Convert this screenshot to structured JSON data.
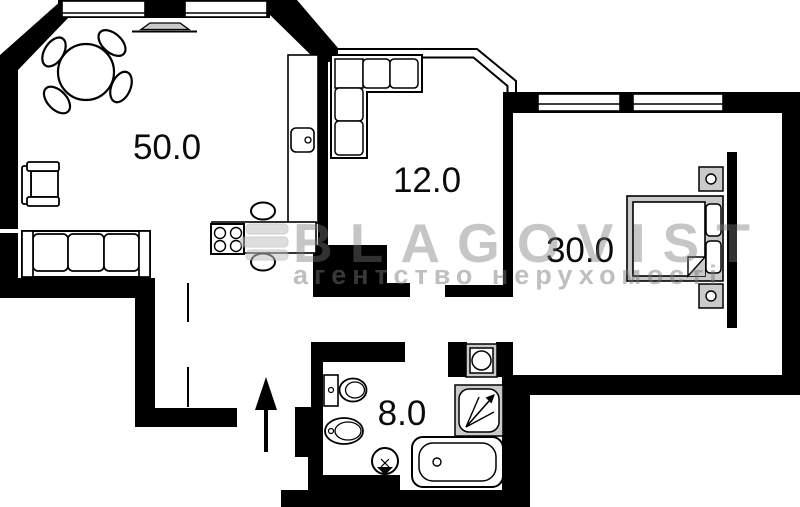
{
  "canvas": {
    "width": 800,
    "height": 507,
    "background": "#ffffff"
  },
  "palette": {
    "wall": "#000000",
    "fixture_outline": "#000000",
    "fixture_fill": "#ffffff",
    "appliance_fill": "#cacaca",
    "watermark_gray": "#bfbfbf"
  },
  "plan_type": "apartment floor plan",
  "rooms": [
    {
      "id": "living-kitchen",
      "area_label": "50.0"
    },
    {
      "id": "room-12",
      "area_label": "12.0"
    },
    {
      "id": "bedroom",
      "area_label": "30.0"
    },
    {
      "id": "bathroom",
      "area_label": "8.0"
    }
  ],
  "watermark": {
    "brand": "BLAGOVIST",
    "tagline": "агентство нерухомості",
    "logo": "blagovist-bars-logo"
  },
  "icons": [
    "entrance-arrow",
    "stove-burners",
    "kitchen-sink",
    "toilet",
    "bidet",
    "washbasin",
    "washing-machine",
    "shower-cabin",
    "bathtub",
    "bed",
    "dining-table",
    "sofa",
    "corner-sofa",
    "armchair"
  ]
}
